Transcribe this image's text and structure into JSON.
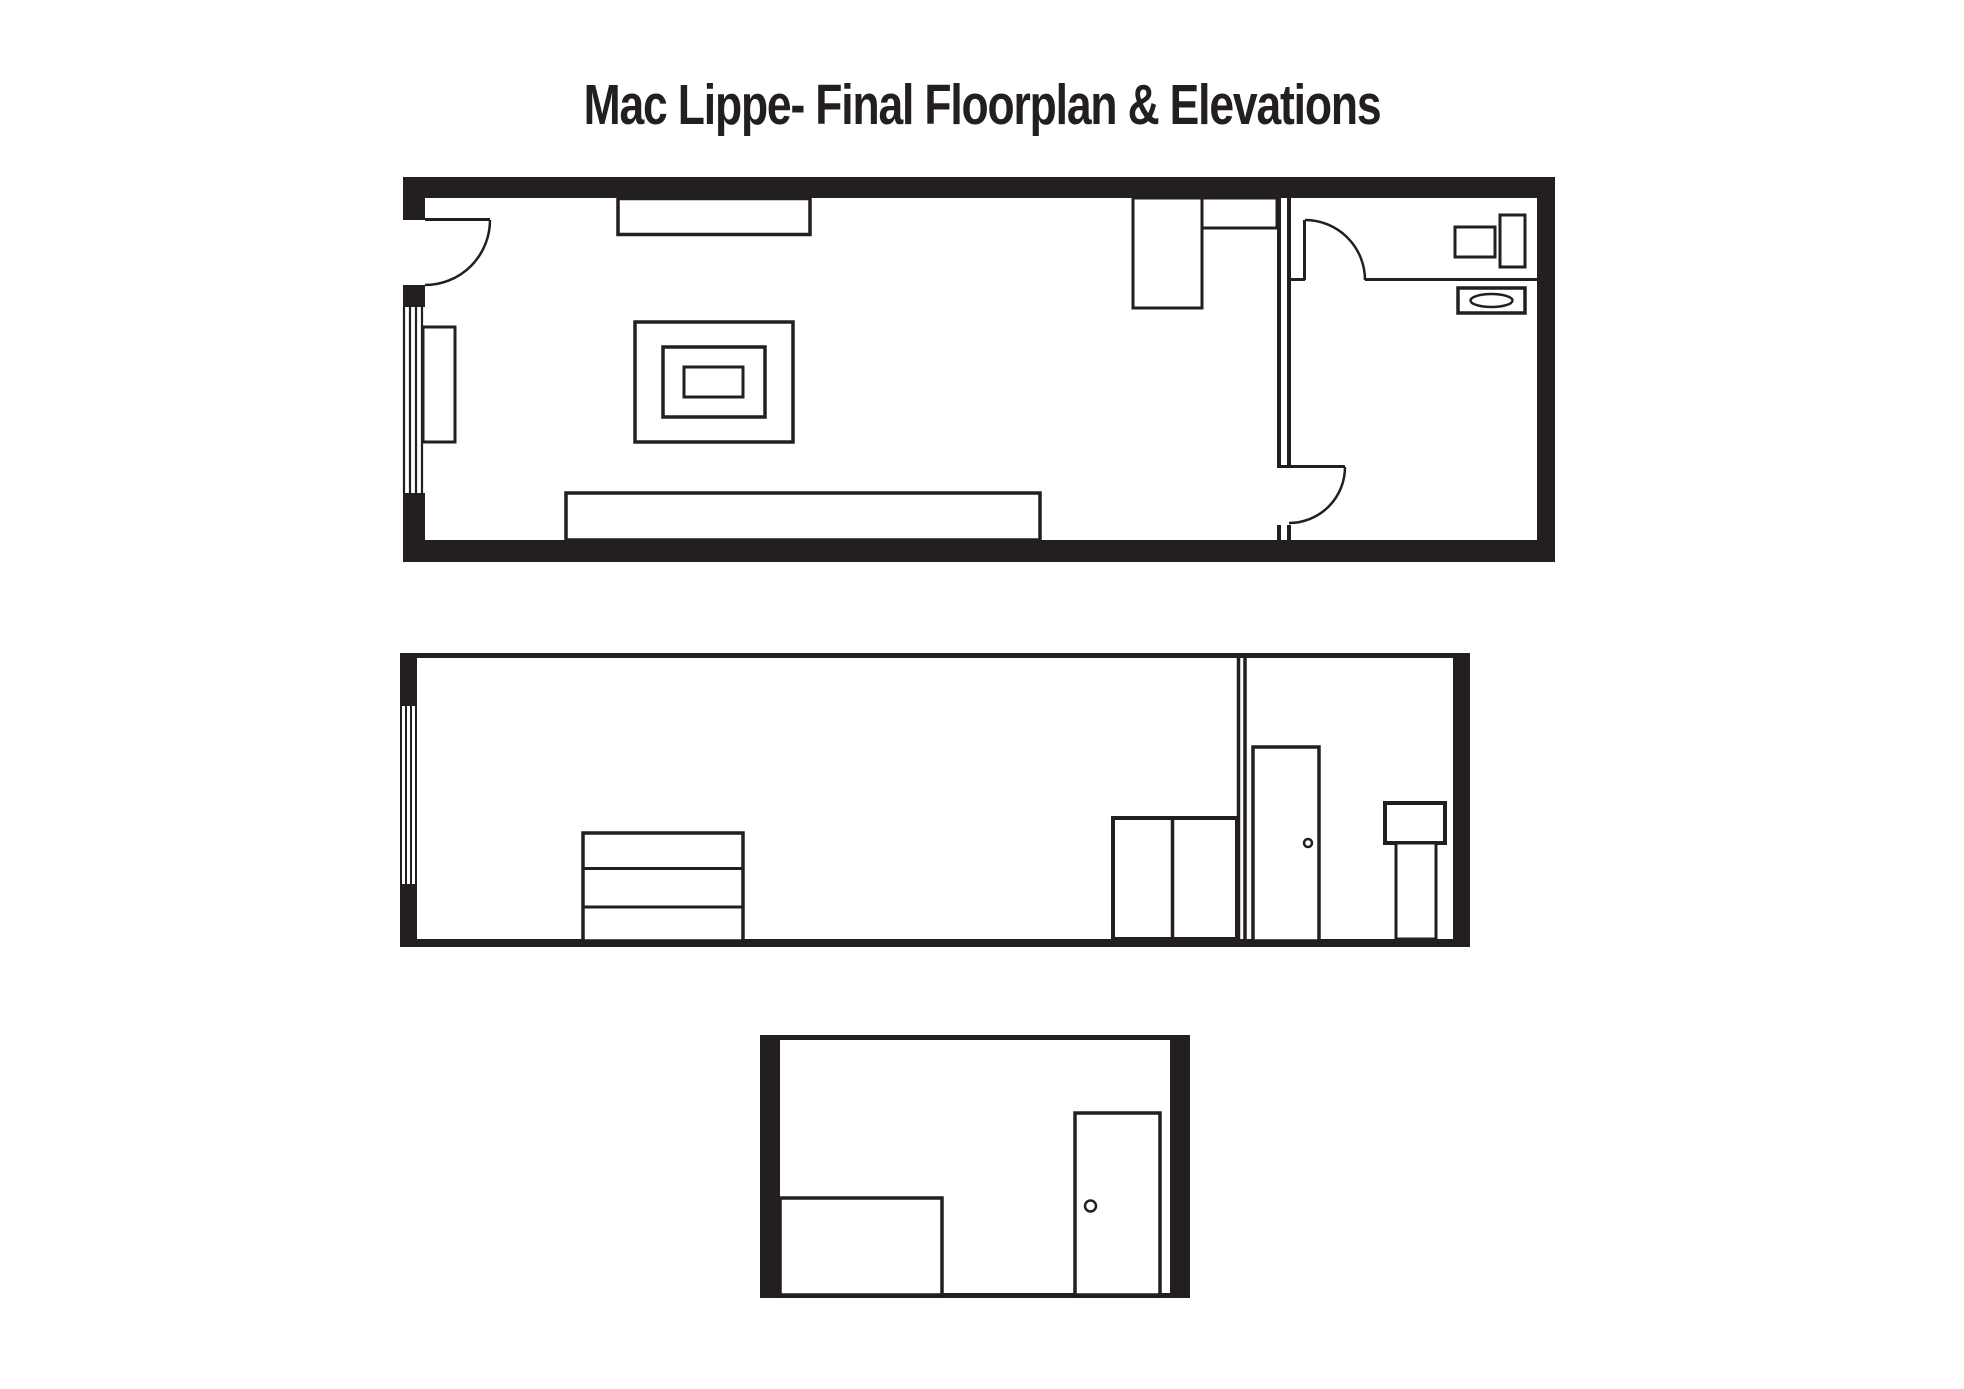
{
  "page": {
    "title": "Mac Lippe- Final Floorplan & Elevations",
    "background_color": "#ffffff",
    "ink_color": "#231f20"
  },
  "drawings": {
    "floorplan": {
      "label": "floorplan",
      "elements": [
        "exterior-walls",
        "entry-door",
        "window",
        "window-seat",
        "wall-shelf",
        "coffee-table",
        "sofa",
        "desk",
        "desk-shelf",
        "partition-wall",
        "interior-door",
        "bathroom-door",
        "toilet",
        "toilet-tank",
        "bathroom-sink"
      ]
    },
    "long_elevation": {
      "label": "long-wall-elevation",
      "elements": [
        "ceiling-line",
        "floor-line",
        "window-wall",
        "dresser",
        "partition-wall",
        "door",
        "door-knob",
        "wardrobe",
        "pedestal-sink"
      ]
    },
    "end_elevation": {
      "label": "end-wall-elevation",
      "elements": [
        "ceiling-line",
        "floor-line",
        "bed",
        "door",
        "door-knob"
      ]
    }
  }
}
